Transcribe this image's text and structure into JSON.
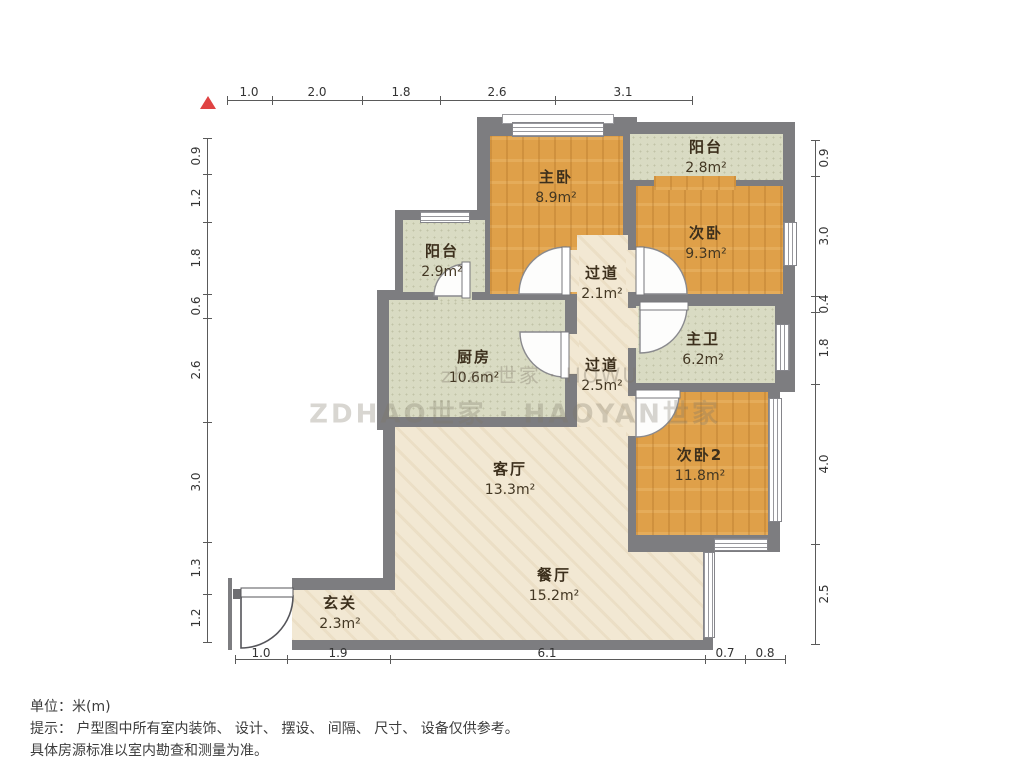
{
  "north_indicator_symbol": "▲",
  "rooms": {
    "master_bedroom": {
      "name": "主卧",
      "area": "8.9m²"
    },
    "balcony_top": {
      "name": "阳台",
      "area": "2.8m²"
    },
    "bedroom2": {
      "name": "次卧",
      "area": "9.3m²"
    },
    "balcony_left": {
      "name": "阳台",
      "area": "2.9m²"
    },
    "hallway1": {
      "name": "过道",
      "area": "2.1m²"
    },
    "kitchen": {
      "name": "厨房",
      "area": "10.6m²"
    },
    "hallway2": {
      "name": "过道",
      "area": "2.5m²"
    },
    "master_bath": {
      "name": "主卫",
      "area": "6.2m²"
    },
    "bedroom3": {
      "name": "次卧2",
      "area": "11.8m²"
    },
    "living_room": {
      "name": "客厅",
      "area": "13.3m²"
    },
    "dining_room": {
      "name": "餐厅",
      "area": "15.2m²"
    },
    "entry": {
      "name": "玄关",
      "area": "2.3m²"
    }
  },
  "dims": {
    "top": [
      "1.0",
      "2.0",
      "1.8",
      "2.6",
      "3.1"
    ],
    "bottom": [
      "1.0",
      "1.9",
      "6.1",
      "0.7",
      "0.8"
    ],
    "left": [
      "0.9",
      "1.2",
      "1.8",
      "0.6",
      "2.6",
      "3.0",
      "1.3",
      "1.2"
    ],
    "right": [
      "0.9",
      "3.0",
      "0.4",
      "1.8",
      "4.0",
      "2.5"
    ]
  },
  "watermark": {
    "line1": "zhao世家 · HOWU",
    "line2": "ZDHAO世家 · HAOYAN世家"
  },
  "footer": {
    "line1": "单位：米(m)",
    "line2": "提示： 户型图中所有室内装饰、 设计、 摆设、 间隔、 尺寸、 设备仅供参考。",
    "line3": "具体房源标准以室内勘查和测量为准。"
  },
  "colors": {
    "wall": "#7d7d80",
    "wood_floor": "#dfa049",
    "tile_floor": "#d9dbc3",
    "marble_floor": "#f2e8d3",
    "north_red": "#e04343"
  }
}
